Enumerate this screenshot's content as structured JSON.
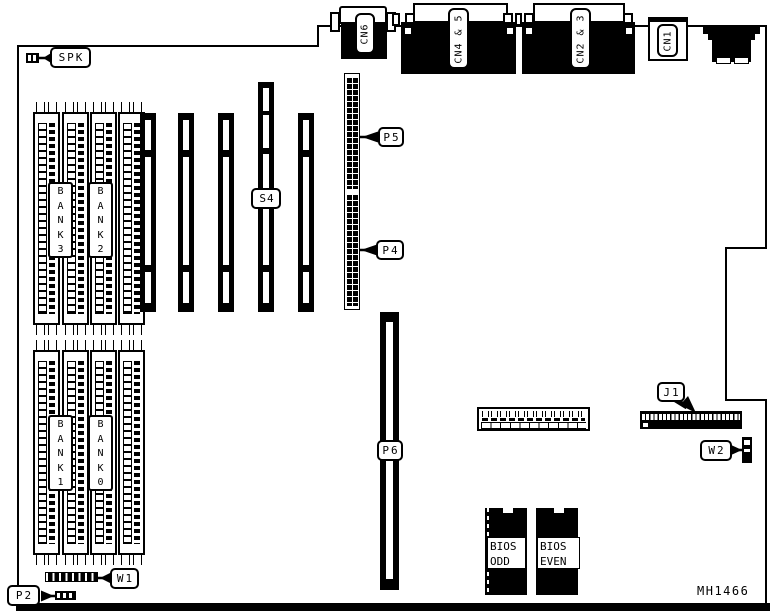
{
  "diagram": {
    "type": "motherboard-layout",
    "part_number": "MH1466",
    "callouts": {
      "spk": "SPK",
      "p5": "P5",
      "p4": "P4",
      "w1": "W1",
      "p2": "P2",
      "w2": "W2",
      "j1": "J1"
    },
    "top_connectors": {
      "cn6": "CN6",
      "cn4_5": "CN4 & 5",
      "cn2_3": "CN2 & 3",
      "cn1": "CN1"
    },
    "slots": {
      "s4": "S4",
      "p6": "P6"
    },
    "memory_banks": {
      "bank3": "B\nA\nN\nK\n3",
      "bank2": "B\nA\nN\nK\n2",
      "bank1": "B\nA\nN\nK\n1",
      "bank0": "B\nA\nN\nK\n0"
    },
    "bios": {
      "odd": "BIOS\nODD",
      "even": "BIOS\nEVEN"
    },
    "colors": {
      "ink": "#000000",
      "board": "#ffffff"
    }
  }
}
